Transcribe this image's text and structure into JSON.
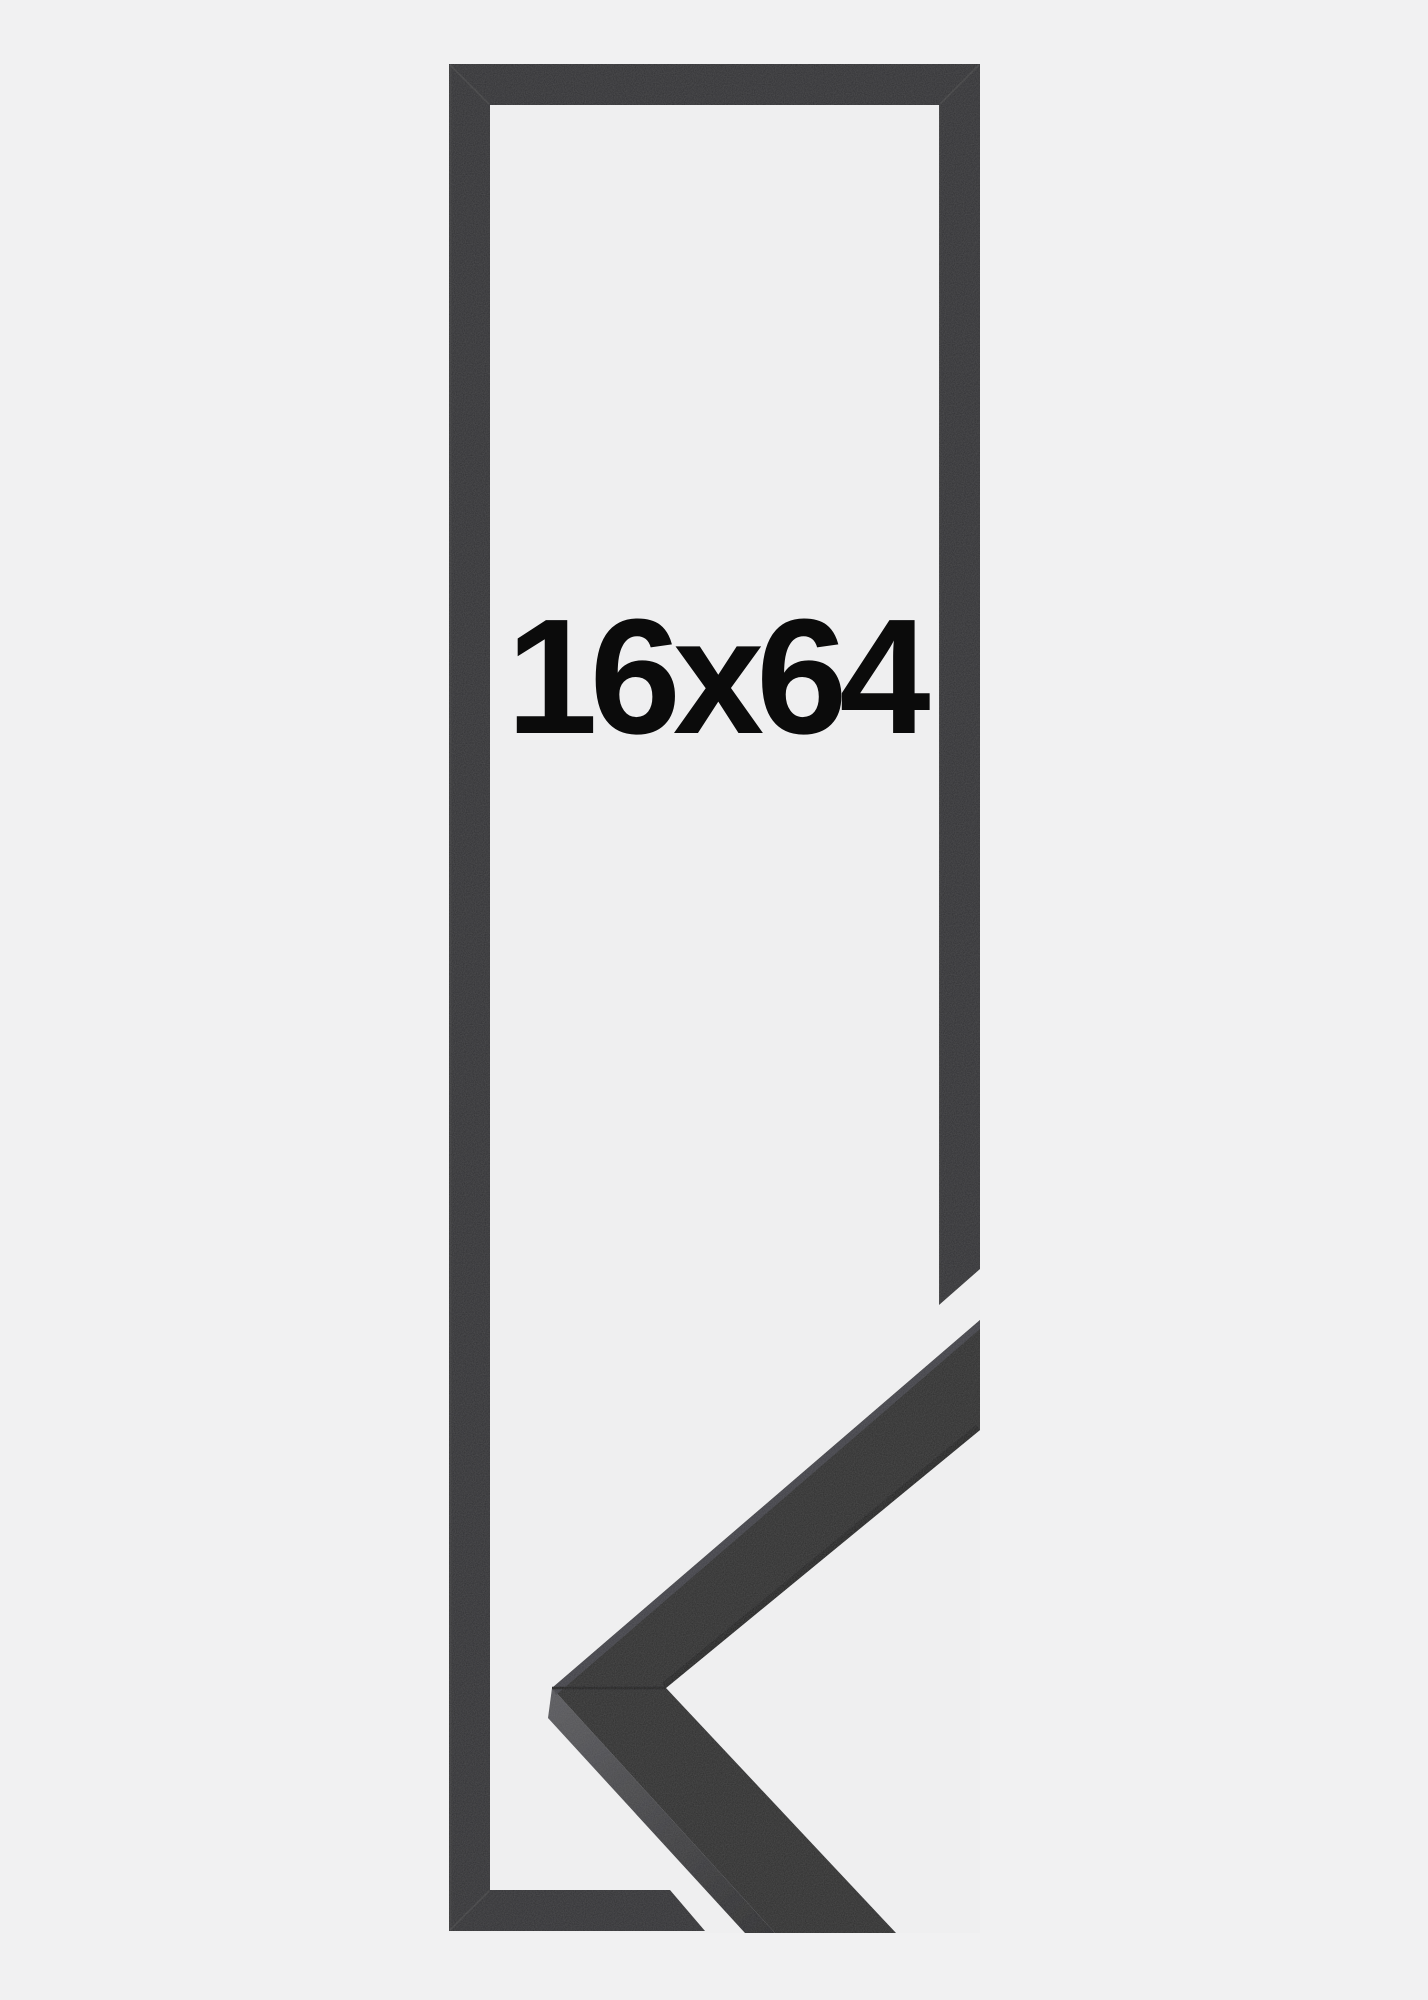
{
  "product_image": {
    "size_label": "16x64",
    "colors": {
      "page_background": "#f1f1f2",
      "photo_background": "#efeff0",
      "frame": "#333335",
      "moulding_face": "#2d2d2f",
      "moulding_top": "#48484c",
      "moulding_edge_dark": "#1d1d1f",
      "moulding_side_light": "#5a5a5e",
      "moulding_side_dark": "#2b2b2d",
      "label_text": "#0b0b0b"
    }
  }
}
